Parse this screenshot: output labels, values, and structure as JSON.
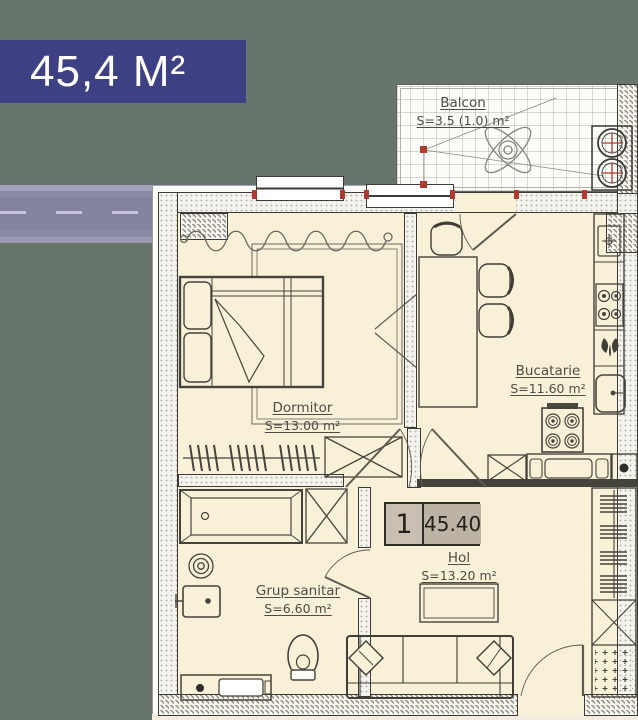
{
  "badge": {
    "label": "45,4 M²"
  },
  "unit": {
    "number": "1",
    "total_area": "45.40"
  },
  "rooms": {
    "balcon": {
      "name": "Balcon",
      "area": "S=3.5 (1.0) m²"
    },
    "dormitor": {
      "name": "Dormitor",
      "area": "S=13.00 m²"
    },
    "bucatarie": {
      "name": "Bucatarie",
      "area": "S=11.60 m²"
    },
    "grup_sanitar": {
      "name": "Grup sanitar",
      "area": "S=6.60 m²"
    },
    "hol": {
      "name": "Hol",
      "area": "S=13.20 m²"
    }
  },
  "colors": {
    "badge_bg": "#3d4183",
    "badge_text": "#ffffff",
    "room_fill": "#f8f1d7",
    "paper": "#fcfcf9",
    "wall_line": "#3b3a34",
    "accent_red": "#b03a2e",
    "unit_box_left_bg": "#c9c0b3",
    "unit_box_right_bg": "#bdb3a4"
  }
}
